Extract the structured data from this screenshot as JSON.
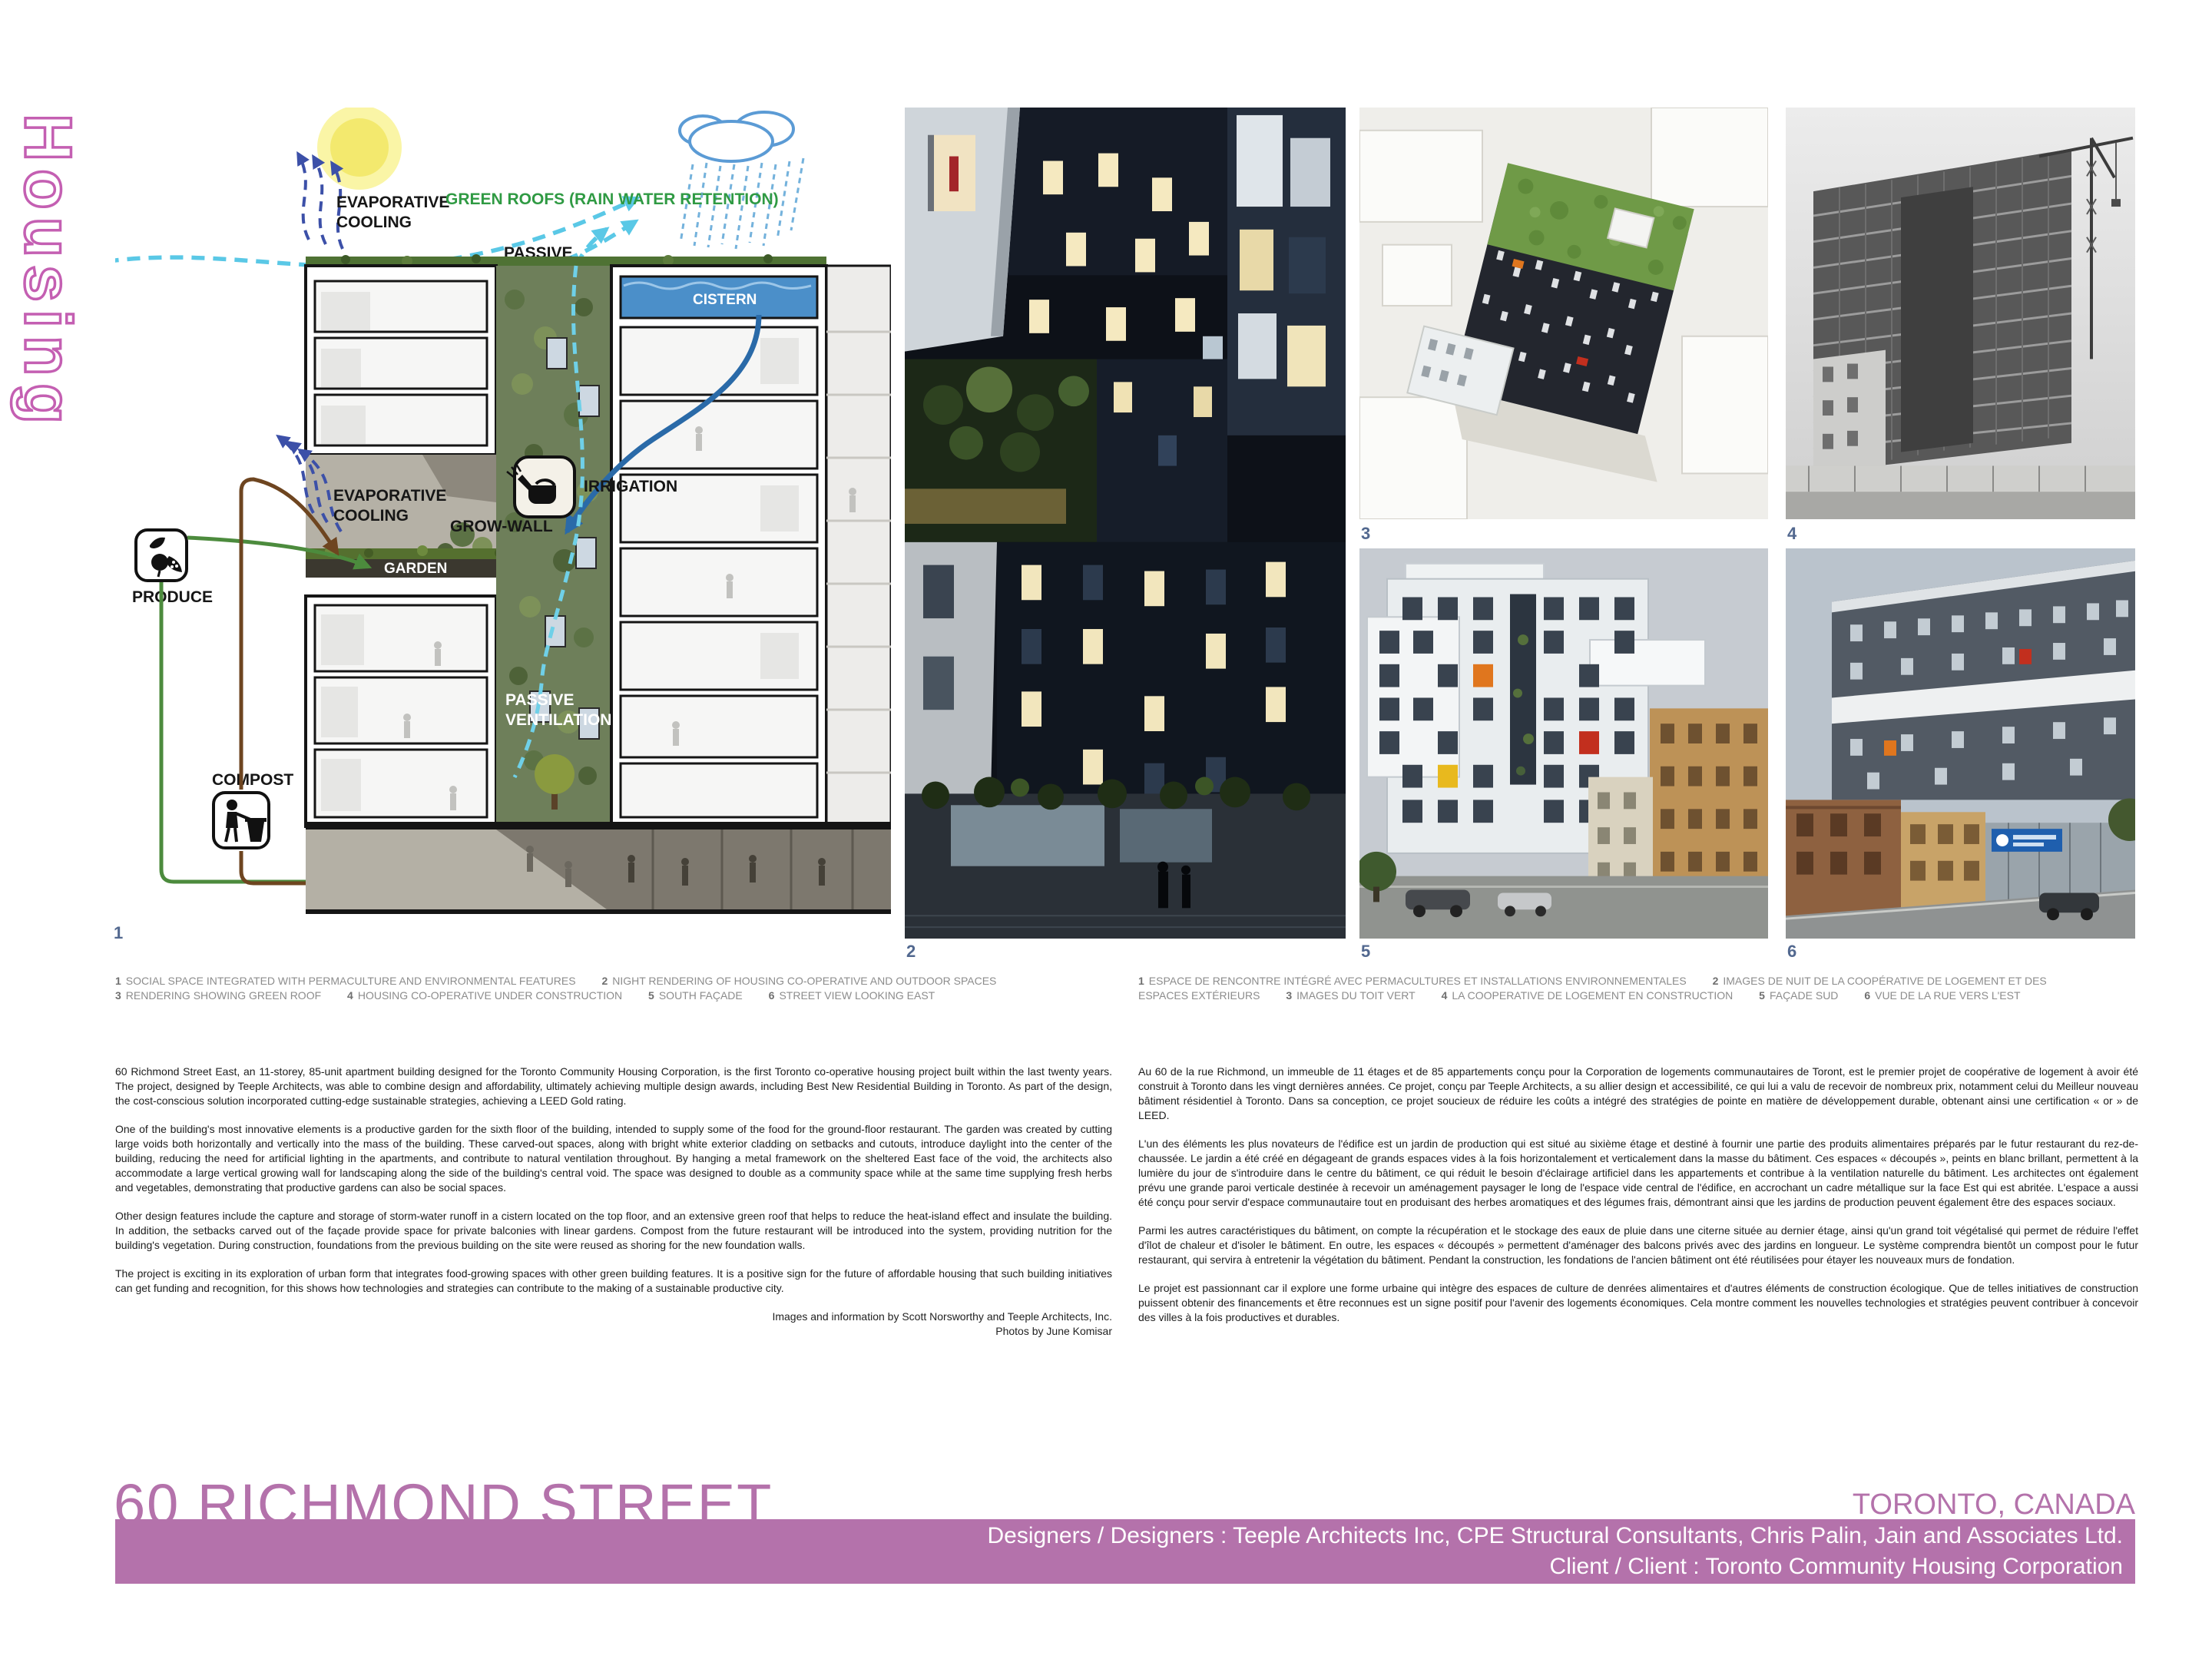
{
  "sidebar": {
    "vertical_title": "Housing"
  },
  "colors": {
    "accent_bar": "#b472ab",
    "housing_outline": "#c45fb2",
    "green_label": "#2f9a43",
    "cyan_flow": "#5ac8e6",
    "figure_number": "#52688f"
  },
  "diagram": {
    "figure_number": "1",
    "labels": {
      "evap1": "EVAPORATIVE",
      "evap2": "COOLING",
      "green_roofs": "GREEN ROOFS (RAIN WATER RETENTION)",
      "passive1": "PASSIVE",
      "passive2": "VENTILATION",
      "cistern": "CISTERN",
      "irrigation": "IRRIGATION",
      "grow_wall": "GROW-WALL",
      "garden": "GARDEN",
      "produce": "PRODUCE",
      "compost": "COMPOST",
      "restaurant": "RESTAURANT"
    }
  },
  "photos": {
    "n2": "2",
    "n3": "3",
    "n4": "4",
    "n5": "5",
    "n6": "6"
  },
  "captions_en": [
    {
      "n": "1",
      "t": "SOCIAL SPACE INTEGRATED WITH PERMACULTURE AND ENVIRONMENTAL FEATURES"
    },
    {
      "n": "2",
      "t": "NIGHT RENDERING OF HOUSING CO-OPERATIVE AND OUTDOOR SPACES"
    },
    {
      "n": "3",
      "t": "RENDERING SHOWING GREEN ROOF"
    },
    {
      "n": "4",
      "t": "HOUSING CO-OPERATIVE UNDER CONSTRUCTION"
    },
    {
      "n": "5",
      "t": "SOUTH FAÇADE"
    },
    {
      "n": "6",
      "t": "STREET VIEW LOOKING EAST"
    }
  ],
  "captions_fr": [
    {
      "n": "1",
      "t": "ESPACE DE RENCONTRE INTÉGRÉ AVEC PERMACULTURES ET INSTALLATIONS ENVIRONNEMENTALES"
    },
    {
      "n": "2",
      "t": "IMAGES DE NUIT DE LA COOPÉRATIVE DE LOGEMENT ET DES ESPACES EXTÉRIEURS"
    },
    {
      "n": "3",
      "t": "IMAGES DU TOIT VERT"
    },
    {
      "n": "4",
      "t": "LA COOPERATIVE DE LOGEMENT EN CONSTRUCTION"
    },
    {
      "n": "5",
      "t": "FAÇADE SUD"
    },
    {
      "n": "6",
      "t": "VUE DE LA RUE VERS L'EST"
    }
  ],
  "article_en": {
    "p1": "60 Richmond Street East, an 11-storey, 85-unit apartment building designed for the Toronto Community Housing Corporation, is the first Toronto co-operative housing project built within the last twenty years. The project, designed by Teeple Architects, was able to combine design and affordability, ultimately achieving multiple design awards, including Best New Residential Building in Toronto. As part of the design, the cost-conscious solution incorporated cutting-edge sustainable strategies, achieving a LEED Gold rating.",
    "p2": "One of the building's most innovative elements is a productive garden for the sixth floor of the building, intended to supply some of the food for the ground-floor restaurant. The garden was created by cutting large voids both horizontally and vertically into the mass of the building. These carved-out spaces, along with bright white exterior cladding on setbacks and cutouts, introduce daylight into the center of the building, reducing the need for artificial lighting in the apartments, and contribute to natural ventilation throughout. By hanging a metal framework on the sheltered East face of the void, the architects also accommodate a large vertical growing wall for landscaping along the side of the building's central void. The space was designed to double as a community space while at the same time supplying fresh herbs and vegetables, demonstrating that productive gardens can also be social spaces.",
    "p3": "Other design features include the capture and storage of storm-water runoff in a cistern located on the top floor, and an extensive green roof that helps to reduce the heat-island effect and insulate the building.  In addition, the setbacks carved out of the façade provide space for private balconies with linear gardens. Compost from the future restaurant will be introduced into the system, providing nutrition for the building's vegetation. During construction, foundations from the previous building on the site were reused as shoring for the new foundation walls.",
    "p4": "The project is exciting in its exploration of urban form that integrates food-growing spaces with other green building features. It is a positive sign for the future of affordable housing that such building initiatives can get funding and recognition, for this shows how technologies and strategies can contribute to the making of a sustainable productive city.",
    "credit1": "Images and information by  Scott Norsworthy and Teeple Architects, Inc.",
    "credit2": "Photos by June Komisar"
  },
  "article_fr": {
    "p1": "Au 60 de la rue Richmond, un immeuble de 11 étages et de 85 appartements conçu pour la Corporation de logements communautaires de Toront, est le premier projet de coopérative de logement à avoir été construit à Toronto dans les vingt dernières années. Ce projet, conçu par Teeple Architects, a su allier design et accessibilité, ce qui lui a valu de recevoir de nombreux prix, notamment celui du Meilleur nouveau bâtiment résidentiel à Toronto. Dans sa conception, ce projet soucieux de réduire les coûts a intégré des stratégies de pointe en matière de développement durable, obtenant ainsi une certification « or » de LEED.",
    "p2": "L'un des éléments les plus novateurs de l'édifice est un jardin de production qui est situé au sixième étage et destiné à fournir une partie des produits alimentaires préparés par le futur restaurant du rez-de-chaussée. Le jardin a été créé en dégageant de grands espaces vides à la fois horizontalement et verticalement dans la masse du bâtiment. Ces espaces « découpés », peints en blanc brillant, permettent à la lumière du jour de s'introduire dans le centre du bâtiment, ce qui réduit le besoin d'éclairage artificiel dans les appartements et contribue à la ventilation naturelle du bâtiment. Les architectes ont également prévu une grande paroi verticale destinée à recevoir un aménagement paysager le long de l'espace vide central de l'édifice, en accrochant un cadre métallique sur la face Est qui est abritée.  L'espace a aussi été conçu pour servir d'espace communautaire tout en produisant des herbes aromatiques et des légumes frais, démontrant ainsi que les jardins de production peuvent également être des espaces sociaux.",
    "p3": "Parmi les autres caractéristiques du bâtiment, on compte la récupération et le stockage des eaux de pluie dans une citerne située au dernier étage, ainsi qu'un grand toit végétalisé qui permet de réduire l'effet d'îlot de chaleur et d'isoler le bâtiment. En outre, les espaces « découpés » permettent d'aménager des balcons privés avec des jardins en longueur. Le système comprendra bientôt un compost pour le futur restaurant, qui servira à entretenir la végétation du bâtiment. Pendant la construction, les fondations de l'ancien bâtiment ont été réutilisées pour étayer les nouveaux murs de fondation.",
    "p4": "Le projet est passionnant car il explore une forme urbaine qui intègre des espaces de culture de denrées alimentaires et d'autres éléments de construction écologique. Que de telles initiatives de construction puissent obtenir des financements et être reconnues est un signe positif pour l'avenir des logements économiques. Cela montre comment les nouvelles technologies et stratégies peuvent contribuer à concevoir des villes à la fois productives et durables."
  },
  "footer": {
    "title": "60 RICHMOND STREET",
    "location": "TORONTO, CANADA",
    "designers": "Designers / Designers : Teeple Architects Inc, CPE Structural Consultants, Chris Palin, Jain and Associates Ltd.",
    "client": "Client / Client : Toronto Community Housing Corporation"
  }
}
